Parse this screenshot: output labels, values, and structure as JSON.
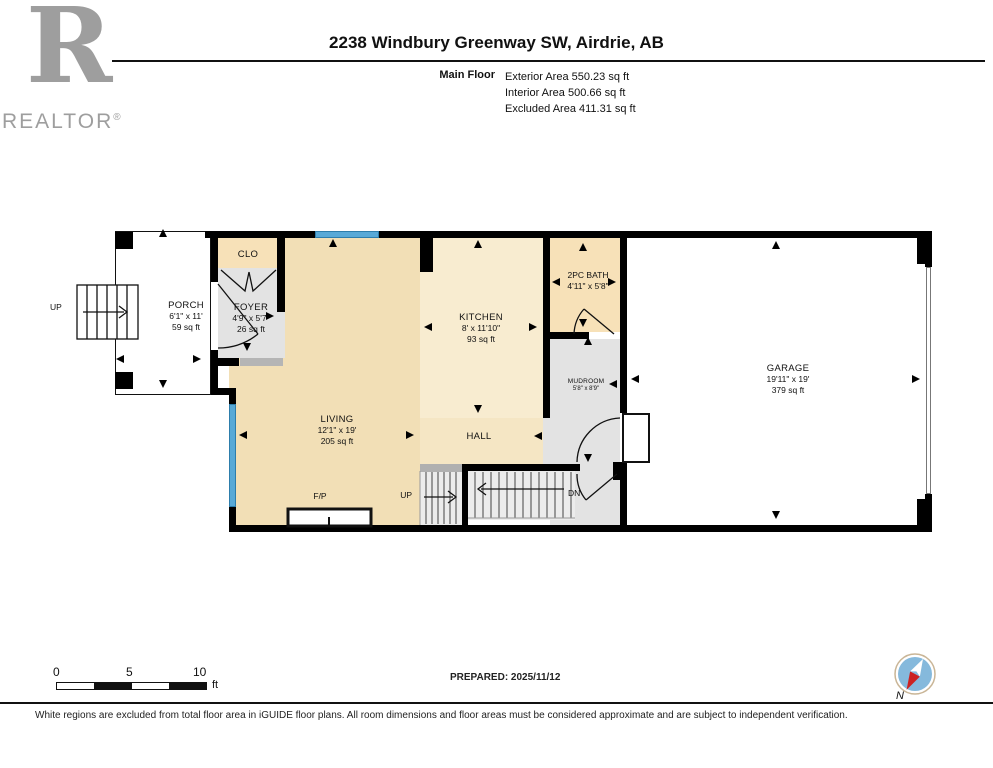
{
  "header": {
    "logo": {
      "letter": "R",
      "brand": "REALTOR",
      "reg": "®"
    },
    "title": "2238 Windbury Greenway SW, Airdrie, AB",
    "floor_label": "Main Floor",
    "area_lines": [
      "Exterior Area 550.23 sq ft",
      "Interior Area 500.66 sq ft",
      "Excluded Area 411.31 sq ft"
    ]
  },
  "rooms": {
    "porch": {
      "name": "PORCH",
      "dims": "6'1\" x 11'",
      "area": "59 sq ft"
    },
    "clo": {
      "name": "CLO"
    },
    "foyer": {
      "name": "FOYER",
      "dims": "4'9\" x 5'7\"",
      "area": "26 sq ft"
    },
    "living": {
      "name": "LIVING",
      "dims": "12'1\" x 19'",
      "area": "205 sq ft"
    },
    "kitchen": {
      "name": "KITCHEN",
      "dims": "8' x 11'10\"",
      "area": "93 sq ft"
    },
    "bath": {
      "name": "2PC BATH",
      "dims": "4'11\" x 5'8\""
    },
    "mudroom": {
      "name": "MUDROOM",
      "dims": "5'8\" x 8'9\""
    },
    "hall": {
      "name": "HALL"
    },
    "garage": {
      "name": "GARAGE",
      "dims": "19'11\" x 19'",
      "area": "379 sq ft"
    },
    "fireplace": {
      "name": "F/P"
    }
  },
  "stairs": {
    "porch_up": "UP",
    "up": "UP",
    "down": "DN"
  },
  "scale_bar": {
    "t0": "0",
    "t5": "5",
    "t10": "10",
    "unit": "ft"
  },
  "prepared": "PREPARED: 2025/11/12",
  "compass": {
    "label": "N"
  },
  "disclaimer": "White regions are excluded from total floor area in iGUIDE floor plans. All room dimensions and floor areas must be considered approximate and are subject to independent verification.",
  "colors": {
    "wall": "#000000",
    "window_blue": "#58a9d7",
    "room_tan": "#f2dfb6",
    "room_cream": "#f8ecd0",
    "room_gray": "#e3e3e3",
    "logo_gray": "#9e9e9e",
    "compass_red": "#cc2222",
    "compass_blue": "#85b9dc"
  }
}
